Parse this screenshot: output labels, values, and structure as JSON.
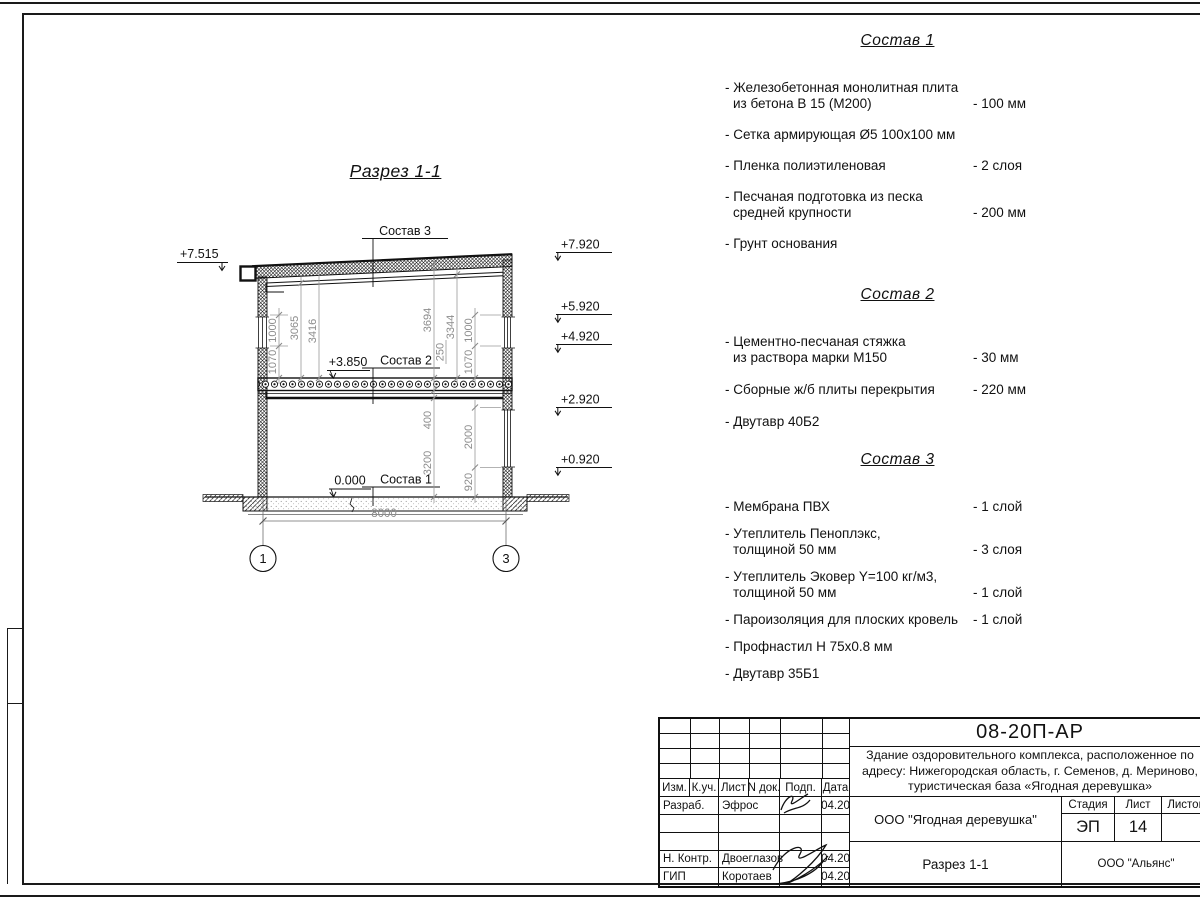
{
  "drawing": {
    "title": "Разрез 1-1",
    "levels": {
      "l7515": "+7.515",
      "r7920": "+7.920",
      "r5920": "+5.920",
      "r4920": "+4.920",
      "r2920": "+2.920",
      "r0920": "+0.920",
      "m3850": "+3.850",
      "floor": "0.000"
    },
    "callouts": {
      "c1": "Состав 1",
      "c2": "Состав 2",
      "c3": "Состав 3"
    },
    "dims": {
      "la": "1000",
      "lb": "1070",
      "lc": "3065",
      "ld": "3416",
      "ra": "3694",
      "rb": "3344",
      "rc": "250",
      "rd": "1000",
      "re": "1070",
      "fa": "400",
      "fb": "3200",
      "fc": "2000",
      "fd": "920",
      "span": "8000"
    },
    "axes": {
      "a1": "1",
      "a3": "3"
    }
  },
  "comps": [
    {
      "title": "Состав 1",
      "items": [
        {
          "line1": "- Железобетонная  монолитная плита",
          "line2": "из бетона В 15 (М200)",
          "value": "- 100 мм"
        },
        {
          "line1": "- Сетка армирующая Ø5 100х100 мм",
          "line2": "",
          "value": ""
        },
        {
          "line1": "- Пленка полиэтиленовая",
          "line2": "",
          "value": "-  2 слоя"
        },
        {
          "line1": "- Песчаная подготовка из песка",
          "line2": "средней крупности",
          "value": "- 200 мм"
        },
        {
          "line1": "- Грунт основания",
          "line2": "",
          "value": ""
        }
      ]
    },
    {
      "title": "Состав 2",
      "items": [
        {
          "line1": "- Цементно-песчаная стяжка",
          "line2": "из раствора марки М150",
          "value": "- 30 мм"
        },
        {
          "line1": "- Сборные ж/б плиты перекрытия",
          "line2": "",
          "value": "- 220 мм"
        },
        {
          "line1": "- Двутавр 40Б2",
          "line2": "",
          "value": ""
        }
      ]
    },
    {
      "title": "Состав 3",
      "items": [
        {
          "line1": "- Мембрана ПВХ",
          "line2": "",
          "value": "- 1 слой"
        },
        {
          "line1": "- Утеплитель Пеноплэкс,",
          "line2": "толщиной 50 мм",
          "value": "- 3 слоя"
        },
        {
          "line1": "- Утеплитель Эковер Y=100 кг/м3,",
          "line2": "толщиной 50 мм",
          "value": "- 1 слой"
        },
        {
          "line1": "- Пароизоляция для плоских кровель",
          "line2": "",
          "value": "- 1 слой"
        },
        {
          "line1": "- Профнастил Н 75х0.8 мм",
          "line2": "",
          "value": ""
        },
        {
          "line1": "- Двутавр 35Б1",
          "line2": "",
          "value": ""
        }
      ]
    }
  ],
  "titleblock": {
    "doc_number": "08-20П-АР",
    "project_line1": "Здание оздоровительного комплекса, расположенное по",
    "project_line2": "адресу: Нижегородская область, г. Семенов, д. Мериново,",
    "project_line3": "туристическая база «Ягодная деревушка»",
    "object_name": "ООО \"Ягодная деревушка\"",
    "sheet_title": "Разрез 1-1",
    "company": "ООО \"Альянс\"",
    "stage_label": "Стадия",
    "sheet_label": "Лист",
    "sheets_label": "Листов",
    "stage": "ЭП",
    "sheet_no": "14",
    "header": {
      "izm": "Изм.",
      "kuch": "К.уч.",
      "list": "Лист",
      "ndok": "N док.",
      "podp": "Подп.",
      "data": "Дата"
    },
    "rows": [
      {
        "role": "Разраб.",
        "name": "Эфрос",
        "date": "04.20"
      },
      {
        "role": "Н. Контр.",
        "name": "Двоеглазов",
        "date": "04.20"
      },
      {
        "role": "ГИП",
        "name": "Коротаев",
        "date": "04.20"
      }
    ]
  }
}
